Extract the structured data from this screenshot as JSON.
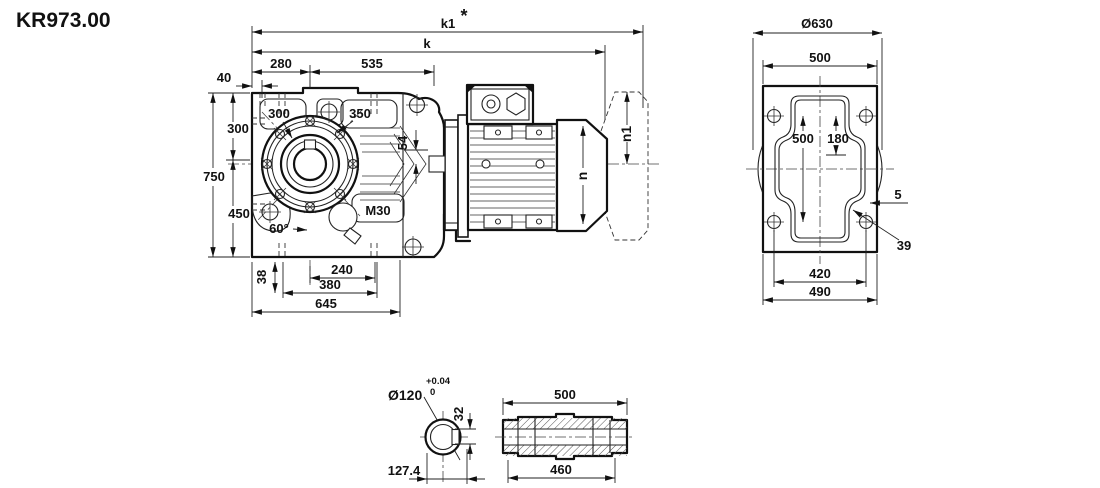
{
  "title": "KR973.00",
  "front_view": {
    "k1": "k1",
    "k1_note": "*",
    "k": "k",
    "w40": "40",
    "w280": "280",
    "w535": "535",
    "h300": "300",
    "h750": "750",
    "h450": "450",
    "h38": "38",
    "w240": "240",
    "w380": "380",
    "w645": "645",
    "flange_pilot": "300",
    "flange_bolt_circle": "350",
    "offset54": "54",
    "angle60": "60°",
    "plug_thread": "M30"
  },
  "motor_view": {
    "n": "n",
    "n1": "n1"
  },
  "end_view": {
    "d630": "Ø630",
    "w500_top": "500",
    "v500": "500",
    "v180": "180",
    "wall5": "5",
    "hole39": "39",
    "w420": "420",
    "w490": "490"
  },
  "shaft_bore": {
    "d120": "Ø120",
    "tol_plus": "+0.04",
    "tol_zero": "0",
    "key32": "32",
    "w127": "127.4"
  },
  "shaft_sleeve": {
    "l500": "500",
    "l460": "460"
  }
}
